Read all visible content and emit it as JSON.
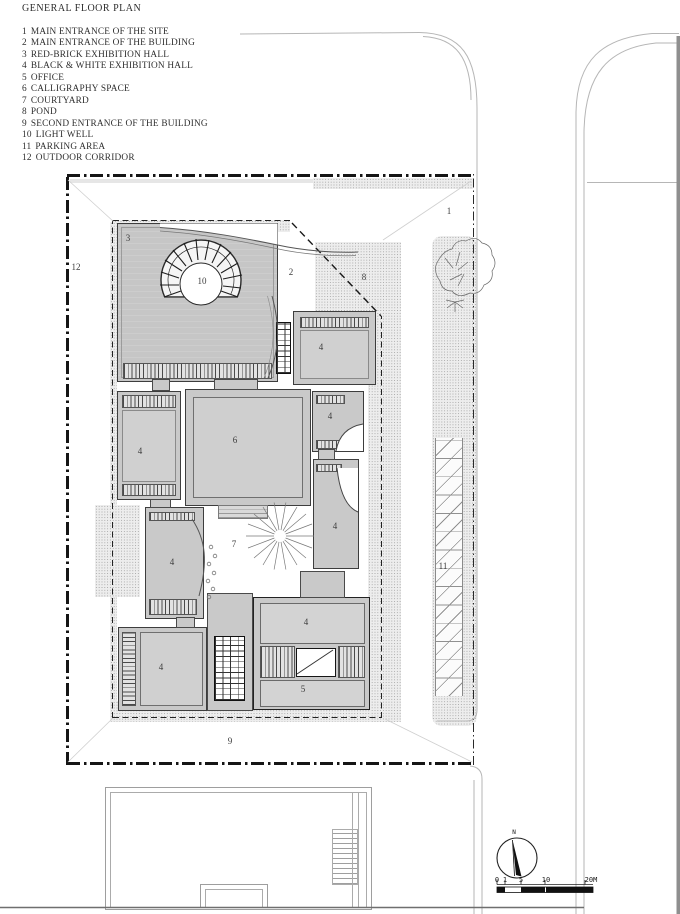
{
  "title": "GENERAL FLOOR PLAN",
  "legend": {
    "items": [
      {
        "n": "1",
        "label": "MAIN ENTRANCE OF THE SITE"
      },
      {
        "n": "2",
        "label": "MAIN ENTRANCE OF THE BUILDING"
      },
      {
        "n": "3",
        "label": "RED-BRICK EXHIBITION HALL"
      },
      {
        "n": "4",
        "label": "BLACK & WHITE EXHIBITION HALL"
      },
      {
        "n": "5",
        "label": "OFFICE"
      },
      {
        "n": "6",
        "label": "CALLIGRAPHY SPACE"
      },
      {
        "n": "7",
        "label": "COURTYARD"
      },
      {
        "n": "8",
        "label": "POND"
      },
      {
        "n": "9",
        "label": "SECOND ENTRANCE OF THE BUILDING"
      },
      {
        "n": "10",
        "label": "LIGHT WELL"
      },
      {
        "n": "11",
        "label": "PARKING AREA"
      },
      {
        "n": "12",
        "label": "OUTDOOR CORRIDOR"
      }
    ]
  },
  "plan": {
    "labels": [
      {
        "t": "1",
        "x": 449,
        "y": 211
      },
      {
        "t": "2",
        "x": 291,
        "y": 272
      },
      {
        "t": "3",
        "x": 128,
        "y": 238
      },
      {
        "t": "4",
        "x": 321,
        "y": 347
      },
      {
        "t": "4",
        "x": 140,
        "y": 451
      },
      {
        "t": "4",
        "x": 330,
        "y": 416
      },
      {
        "t": "4",
        "x": 335,
        "y": 526
      },
      {
        "t": "4",
        "x": 172,
        "y": 562
      },
      {
        "t": "4",
        "x": 161,
        "y": 667
      },
      {
        "t": "4",
        "x": 306,
        "y": 622
      },
      {
        "t": "5",
        "x": 303,
        "y": 689
      },
      {
        "t": "6",
        "x": 235,
        "y": 440
      },
      {
        "t": "7",
        "x": 234,
        "y": 544
      },
      {
        "t": "8",
        "x": 364,
        "y": 277
      },
      {
        "t": "9",
        "x": 230,
        "y": 741
      },
      {
        "t": "10",
        "x": 202,
        "y": 281
      },
      {
        "t": "11",
        "x": 443,
        "y": 566
      },
      {
        "t": "12",
        "x": 76,
        "y": 267
      }
    ]
  },
  "scalebar": {
    "ticks": [
      {
        "t": "0",
        "x": 497,
        "y": 876
      },
      {
        "t": "1",
        "x": 505,
        "y": 876
      },
      {
        "t": "5",
        "x": 521,
        "y": 876
      },
      {
        "t": "10",
        "x": 546,
        "y": 876
      },
      {
        "t": "20M",
        "x": 591,
        "y": 876
      }
    ]
  },
  "compass": {
    "north_label": "N"
  },
  "colors": {
    "building_fill": "#c9c9c9",
    "boundary_dark": "#151515",
    "road_line": "#b6b6b6",
    "wall_dark": "#8f8f8f"
  }
}
